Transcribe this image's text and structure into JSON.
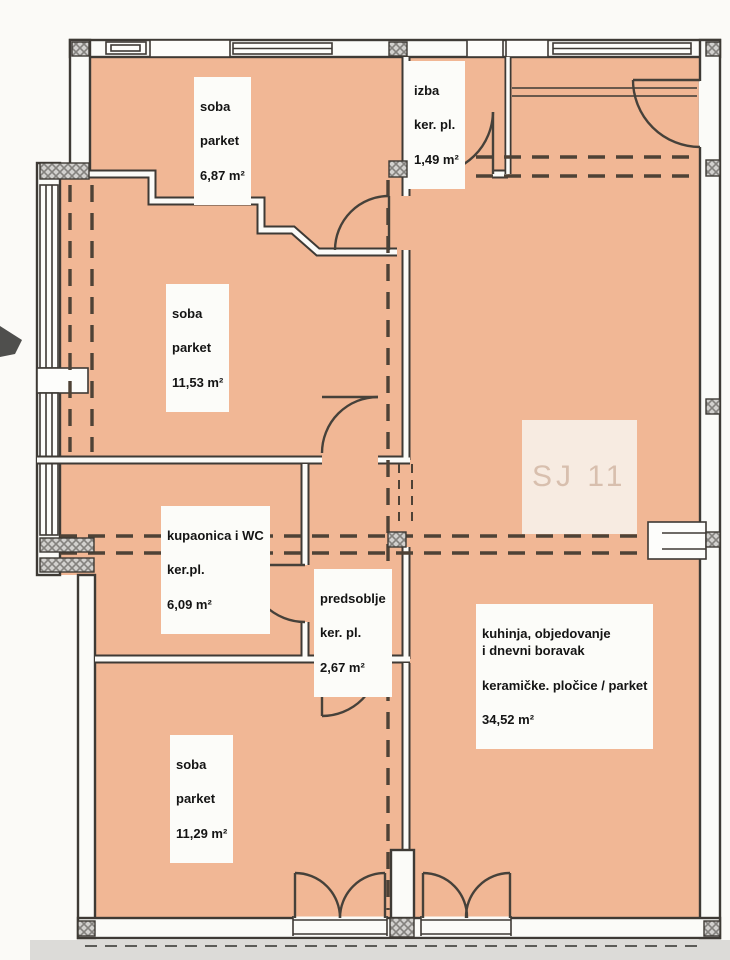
{
  "unit": {
    "label": "SJ 11"
  },
  "rooms": [
    {
      "name": "soba",
      "floor": "parket",
      "area": "6,87 m²"
    },
    {
      "name": "izba",
      "floor": "ker. pl.",
      "area": "1,49 m²"
    },
    {
      "name": "soba",
      "floor": "parket",
      "area": "11,53 m²"
    },
    {
      "name": "kupaonica i WC",
      "floor": "ker.pl.",
      "area": "6,09 m²"
    },
    {
      "name": "predsoblje",
      "floor": "ker. pl.",
      "area": "2,67 m²"
    },
    {
      "name": "soba",
      "floor": "parket",
      "area": "11,29 m²"
    },
    {
      "name": "kuhinja, objedovanje\ni dnevni boravak",
      "floor": "keramičke. pločice / parket",
      "area": "34,52 m²"
    }
  ],
  "colors": {
    "floor_fill": "#f1b795",
    "wall_line": "#3e3a35",
    "wall_fill": "#fbfbf8",
    "dash_line": "#4e4236",
    "unit_label_text": "#d8bfae",
    "outside_strip": "#dcdbd8"
  }
}
